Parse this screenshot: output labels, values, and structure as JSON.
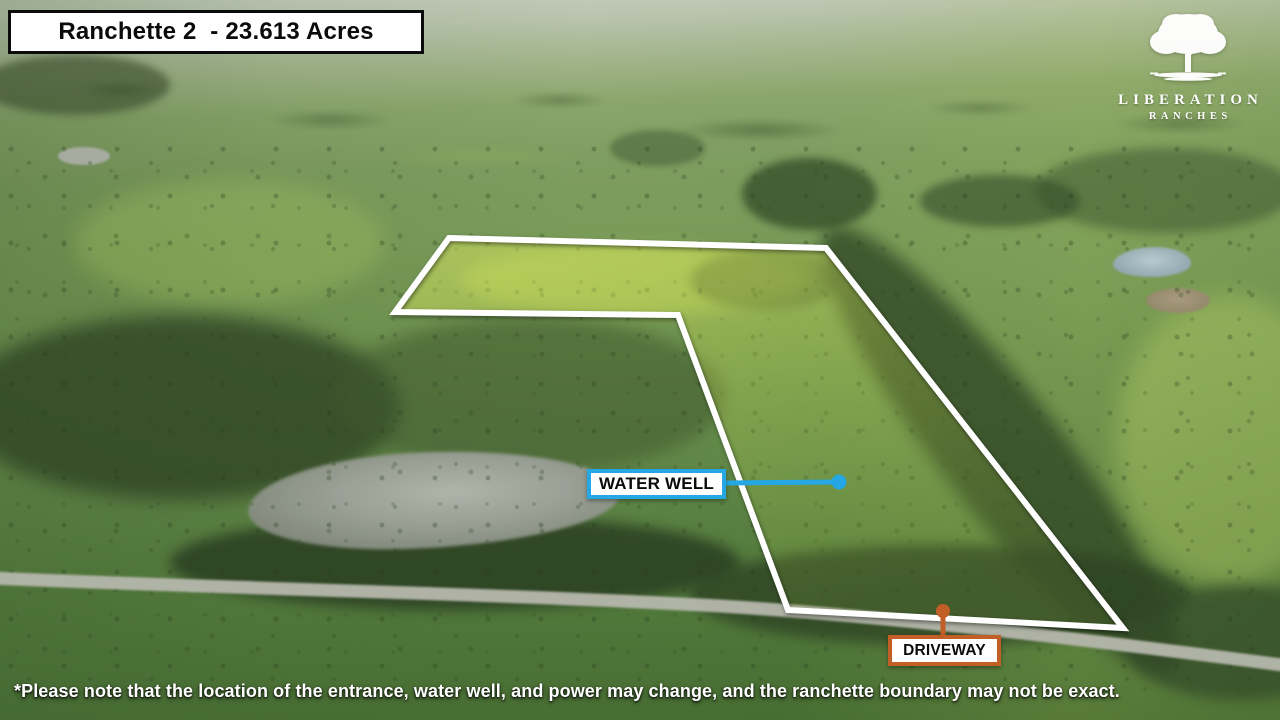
{
  "title": {
    "text": "Ranchette 2  - 23.613 Acres"
  },
  "logo": {
    "line1": "LIBERATION",
    "line2": "RANCHES"
  },
  "annotations": {
    "water_well": {
      "label": "WATER WELL"
    },
    "driveway": {
      "label": "DRIVEWAY"
    }
  },
  "colors": {
    "boundary": "#ffffff",
    "water_well_accent": "#24a7e2",
    "driveway_accent": "#c25f27",
    "label_text": "#0b0b0b"
  },
  "disclaimer": {
    "text": "*Please note that the location of the entrance, water well, and power may change, and the ranchette boundary may not be exact."
  }
}
